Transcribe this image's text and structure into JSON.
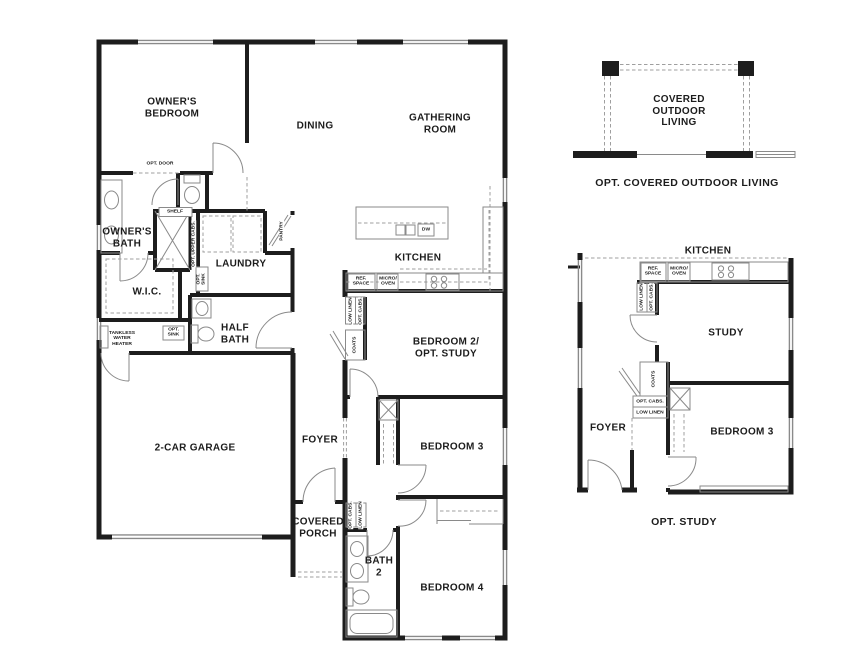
{
  "colors": {
    "wall": "#1d1d1d",
    "thin": "#8a8a8a",
    "dash": "#9f9f9f",
    "text": "#1c1c1c",
    "bg": "#ffffff"
  },
  "main": {
    "rooms": {
      "owners_bedroom": "OWNER'S\nBEDROOM",
      "dining": "DINING",
      "gathering_room": "GATHERING\nROOM",
      "owners_bath": "OWNER'S\nBATH",
      "laundry": "LAUNDRY",
      "wic": "W.I.C.",
      "half_bath": "HALF\nBATH",
      "kitchen": "KITCHEN",
      "bedroom2": "BEDROOM 2/\nOPT. STUDY",
      "garage": "2-CAR GARAGE",
      "foyer": "FOYER",
      "covered_porch": "COVERED\nPORCH",
      "bedroom3": "BEDROOM 3",
      "bath2": "BATH\n2",
      "bedroom4": "BEDROOM 4"
    },
    "labels": {
      "opt_door": "OPT. DOOR",
      "shelf": "SHELF",
      "opt_upper_cabs": "OPT. UPPER CABS.",
      "pantry": "PANTRY",
      "opt_sink_laundry": "OPT.\nSINK",
      "opt_sink_wic": "OPT.\nSINK",
      "tankless_water_heater": "TANKLESS\nWATER\nHEATER",
      "ref_space": "REF.\nSPACE",
      "micro_oven": "MICRO/\nOVEN",
      "dw": "DW",
      "low_linen": "LOW LINEN",
      "opt_cabs": "OPT. CABS.",
      "coats": "COATS",
      "opt_cabs_bath_hall": "OPT. CABS.",
      "low_linen_bath_hall": "LOW LINEN"
    }
  },
  "outdoor_living": {
    "room": "COVERED\nOUTDOOR\nLIVING",
    "caption": "OPT. COVERED OUTDOOR LIVING"
  },
  "opt_study": {
    "labels": {
      "kitchen": "KITCHEN",
      "ref_space": "REF.\nSPACE",
      "micro_oven": "MICRO/\nOVEN",
      "low_linen": "LOW LINEN",
      "opt_cabs": "OPT. CABS.",
      "study": "STUDY",
      "coats": "COATS",
      "opt_cabs_box": "OPT. CABS.",
      "low_linen_box": "LOW LINEN",
      "foyer": "FOYER",
      "bedroom3": "BEDROOM 3"
    },
    "caption": "OPT. STUDY"
  }
}
